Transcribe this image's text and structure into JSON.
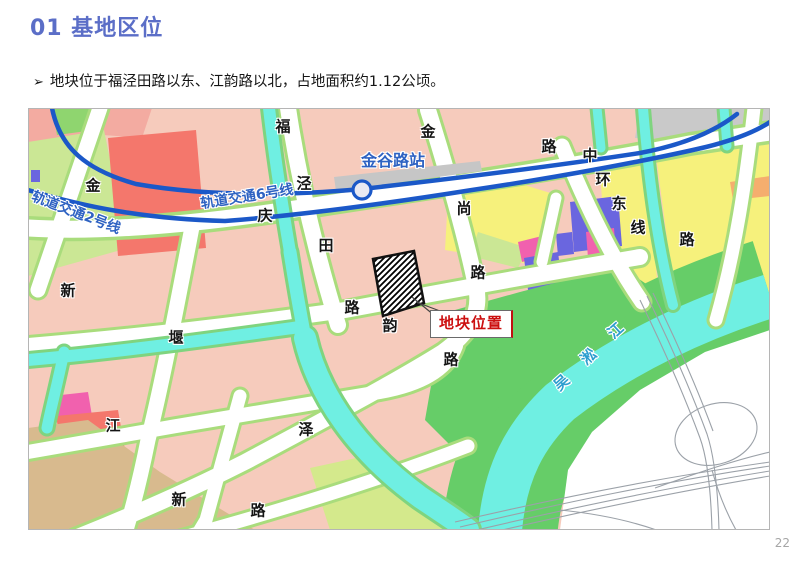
{
  "slide": {
    "title": "01 基地区位",
    "bullet_marker": "➢",
    "bullet": "地块位于福泾田路以东、江韵路以北，占地面积约1.12公顷。",
    "page_number": "22"
  },
  "colors": {
    "title_blue": "#5B6EC7",
    "metro_blue": "#1B58C8",
    "map_label_blue": "#2E62C2",
    "river_text_blue": "#2D9ECF",
    "site_label_red": "#CC1010",
    "block_salmon": "#F6CBBC",
    "block_red": "#F4776C",
    "block_yellow": "#F6F17C",
    "block_green": "#66CD68",
    "block_lightgreen": "#CBE795",
    "block_purple": "#6A66DF",
    "block_magenta": "#F161AE",
    "block_tan": "#D8BA8E",
    "block_orange": "#F5AE6E",
    "block_gray": "#C9C9C9",
    "water_cyan": "#6FEFE2"
  },
  "map": {
    "site_label": "地块位置",
    "station_label": "金谷路站",
    "metro_line_2_label": "轨道交通2号线",
    "metro_line_6_label": "轨道交通6号线",
    "river_name": "吴淞江",
    "labels": [
      {
        "text": "轨道交通2号线",
        "x": 76,
        "y": 213,
        "rot": 21,
        "color": "#2E62C2",
        "size": 14,
        "name": "metro-line-2-label"
      },
      {
        "text": "轨道交通6号线",
        "x": 247,
        "y": 197,
        "rot": -9,
        "color": "#2E62C2",
        "size": 14,
        "name": "metro-line-6-label"
      },
      {
        "text": "金谷路站",
        "x": 393,
        "y": 161,
        "rot": 0,
        "color": "#2E62C2",
        "size": 16,
        "name": "station-label"
      },
      {
        "text": "金",
        "x": 93,
        "y": 186,
        "name": "road-label"
      },
      {
        "text": "福",
        "x": 283,
        "y": 127,
        "name": "road-label"
      },
      {
        "text": "泾",
        "x": 304,
        "y": 184,
        "name": "road-label"
      },
      {
        "text": "田",
        "x": 326,
        "y": 246,
        "name": "road-label"
      },
      {
        "text": "路",
        "x": 352,
        "y": 308,
        "name": "road-label"
      },
      {
        "text": "金",
        "x": 428,
        "y": 132,
        "name": "road-label"
      },
      {
        "text": "路",
        "x": 549,
        "y": 147,
        "name": "road-label"
      },
      {
        "text": "尚",
        "x": 464,
        "y": 209,
        "name": "road-label"
      },
      {
        "text": "路",
        "x": 478,
        "y": 273,
        "name": "road-label"
      },
      {
        "text": "庆",
        "x": 265,
        "y": 216,
        "name": "road-label"
      },
      {
        "text": "中",
        "x": 590,
        "y": 156,
        "name": "road-label"
      },
      {
        "text": "环",
        "x": 603,
        "y": 180,
        "name": "road-label"
      },
      {
        "text": "东",
        "x": 619,
        "y": 204,
        "name": "road-label"
      },
      {
        "text": "线",
        "x": 638,
        "y": 228,
        "name": "road-label"
      },
      {
        "text": "路",
        "x": 687,
        "y": 240,
        "name": "road-label"
      },
      {
        "text": "新",
        "x": 68,
        "y": 291,
        "name": "road-label"
      },
      {
        "text": "堰",
        "x": 176,
        "y": 338,
        "name": "road-label"
      },
      {
        "text": "韵",
        "x": 390,
        "y": 326,
        "name": "road-label"
      },
      {
        "text": "路",
        "x": 451,
        "y": 360,
        "name": "road-label"
      },
      {
        "text": "江",
        "x": 113,
        "y": 426,
        "name": "road-label"
      },
      {
        "text": "泽",
        "x": 306,
        "y": 430,
        "name": "road-label"
      },
      {
        "text": "新",
        "x": 179,
        "y": 500,
        "name": "road-label"
      },
      {
        "text": "路",
        "x": 258,
        "y": 511,
        "name": "road-label"
      },
      {
        "text": "江",
        "x": 616,
        "y": 331,
        "rot": -42,
        "color": "#2D9ECF",
        "name": "river-label"
      },
      {
        "text": "淞",
        "x": 589,
        "y": 357,
        "rot": -42,
        "color": "#2D9ECF",
        "name": "river-label"
      },
      {
        "text": "吴",
        "x": 562,
        "y": 383,
        "rot": -42,
        "color": "#2D9ECF",
        "name": "river-label"
      }
    ]
  }
}
